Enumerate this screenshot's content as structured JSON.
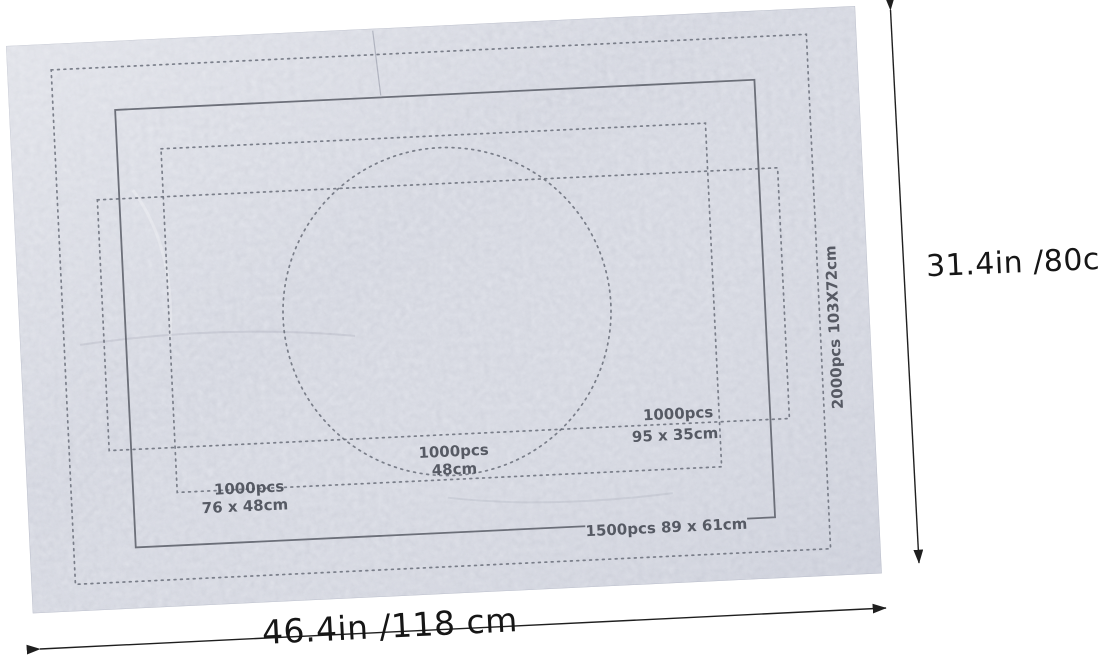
{
  "scene": {
    "background_color": "#ffffff",
    "subject": "felt puzzle sorting mat with printed size outlines"
  },
  "mat": {
    "base_color": "#e9ebf2",
    "outline_color": "#686d79",
    "label_color": "#4c505a",
    "size_labels": {
      "s2000": "2000pcs 103X72cm",
      "s1500": "1500pcs 89 x 61cm",
      "pano_1000_line1": "1000pcs",
      "pano_1000_line2": "95 x 35cm",
      "round_1000_line1": "1000pcs",
      "round_1000_line2": "48cm",
      "std_1000_line1": "1000pcs",
      "std_1000_line2": "76 x 48cm"
    }
  },
  "dimensions": {
    "arrow_color": "#1f1f1f",
    "text_color": "#161616",
    "height_label": "31.4in /80cm",
    "width_label": "46.4in /118 cm"
  }
}
